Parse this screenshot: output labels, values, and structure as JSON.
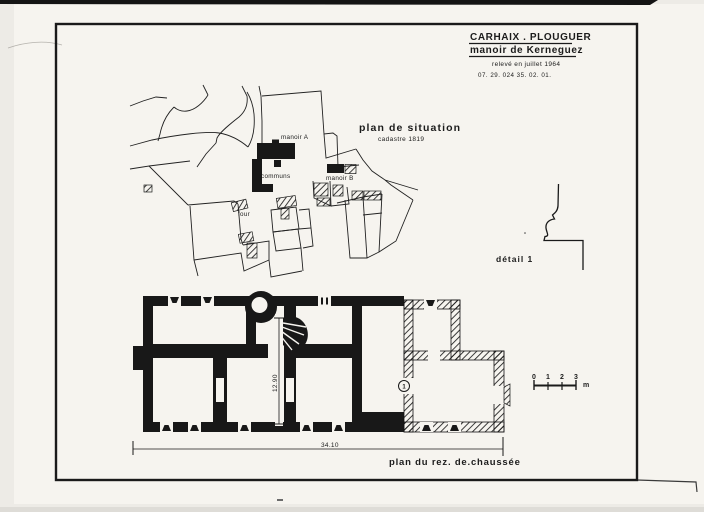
{
  "title_block": {
    "commune": "CARHAIX . PLOUGUER",
    "monument": "manoir de Kerneguez",
    "survey_note": "relevé en juillet 1964",
    "reference": "07. 29. 024 35. 02. 01."
  },
  "site_plan": {
    "title": "plan de situation",
    "subtitle": "cadastre 1819",
    "labels": {
      "manoir_a": "manoir A",
      "communs": "communs",
      "manoir_b": "manoir B",
      "four": "four"
    }
  },
  "detail_view": {
    "caption": "détail 1"
  },
  "floor_plan": {
    "caption": "plan du rez. de.chaussée",
    "width_dim": "34.10",
    "depth_dim": "12.90",
    "detail_marker": "1"
  },
  "scale_bar": {
    "ticks": [
      "0",
      "1",
      "2",
      "3"
    ],
    "unit": "m"
  },
  "colors": {
    "ink": "#181818",
    "paper": "#f6f4ef",
    "background": "#edebe6"
  }
}
